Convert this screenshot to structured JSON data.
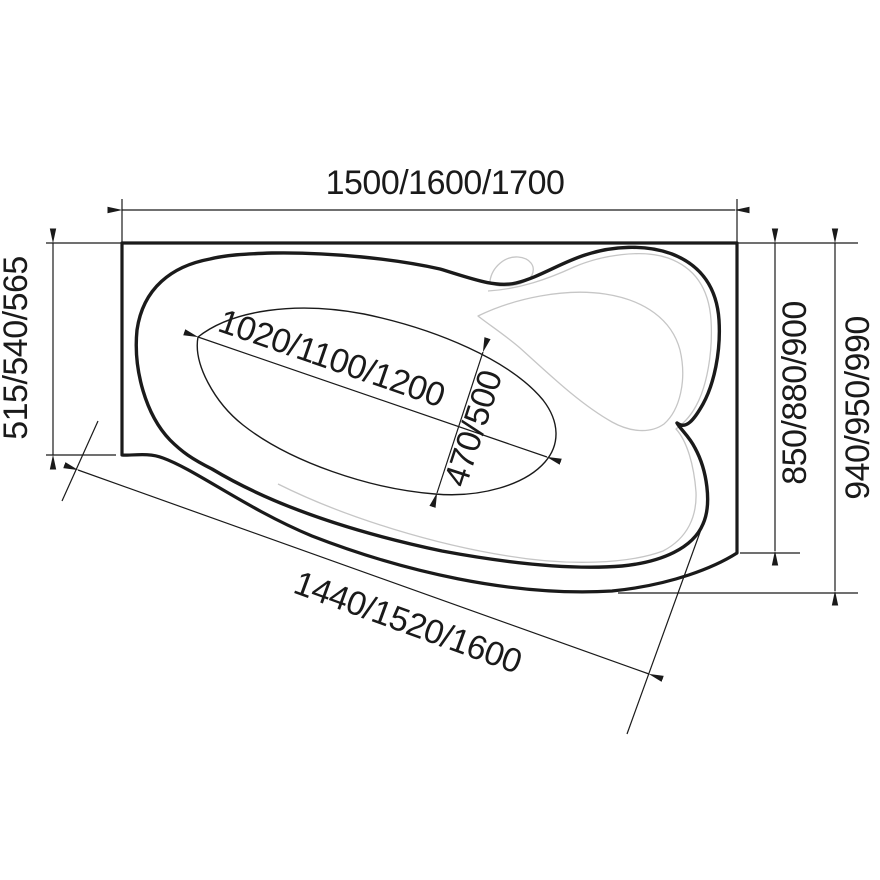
{
  "drawing": {
    "title": "corner bathtub plan-view technical drawing",
    "units": "mm",
    "dimensions": {
      "top_width": "1500/1600/1700",
      "left_depth": "515/540/565",
      "inner_length": "1020/1100/1200",
      "inner_width": "470/500",
      "right_inner_depth": "850/880/900",
      "right_outer_depth": "940/950/990",
      "bottom_edge_length": "1440/1520/1600"
    },
    "colors": {
      "line": "#1a1a1a",
      "light_contour": "#c6c6c6",
      "background": "#ffffff"
    }
  }
}
